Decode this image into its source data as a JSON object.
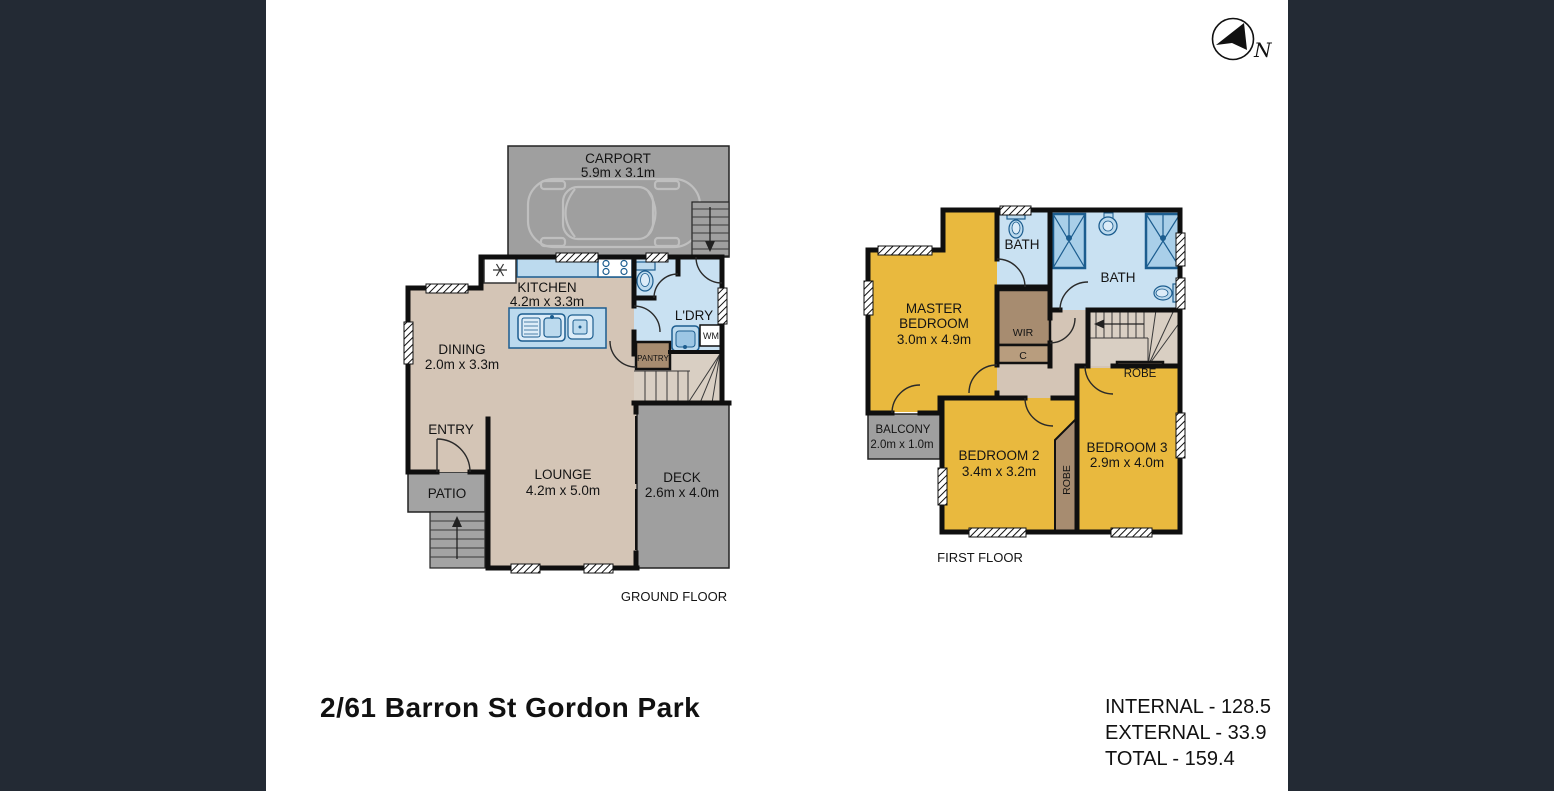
{
  "title": "2/61 Barron St Gordon Park",
  "areas": {
    "internal": "INTERNAL - 128.5",
    "external": "EXTERNAL - 33.9",
    "total": "TOTAL - 159.4"
  },
  "compass": {
    "label": "N"
  },
  "ground_floor": {
    "label": "GROUND FLOOR",
    "carport": {
      "name": "CARPORT",
      "dims": "5.9m x 3.1m"
    },
    "kitchen": {
      "name": "KITCHEN",
      "dims": "4.2m x 3.3m"
    },
    "dining": {
      "name": "DINING",
      "dims": "2.0m x 3.3m"
    },
    "laundry": {
      "name": "L'DRY"
    },
    "pantry": {
      "name": "PANTRY"
    },
    "washing_machine": {
      "name": "WM"
    },
    "entry": {
      "name": "ENTRY"
    },
    "patio": {
      "name": "PATIO"
    },
    "lounge": {
      "name": "LOUNGE",
      "dims": "4.2m x 5.0m"
    },
    "deck": {
      "name": "DECK",
      "dims": "2.6m x 4.0m"
    }
  },
  "first_floor": {
    "label": "FIRST FLOOR",
    "master_bedroom": {
      "name_line1": "MASTER",
      "name_line2": "BEDROOM",
      "dims": "3.0m x 4.9m"
    },
    "bath1": {
      "name": "BATH"
    },
    "bath2": {
      "name": "BATH"
    },
    "wir": {
      "name": "WIR"
    },
    "cupboard": {
      "name": "C"
    },
    "robe_bed3": {
      "name": "ROBE"
    },
    "robe_bed2": {
      "name": "ROBE"
    },
    "balcony": {
      "name": "BALCONY",
      "dims": "2.0m x 1.0m"
    },
    "bedroom2": {
      "name": "BEDROOM 2",
      "dims": "3.4m x 3.2m"
    },
    "bedroom3": {
      "name": "BEDROOM 3",
      "dims": "2.9m x 4.0m"
    }
  },
  "colors": {
    "side_panel": "#232a34",
    "floor_internal": "#d4c5b6",
    "bedroom_yellow": "#e9b93e",
    "wet_area_blue": "#c9e1f2",
    "outdoor_grey": "#9f9f9f",
    "storage_brown": "#a78c70",
    "fixture_blue": "#1c5d8f"
  }
}
